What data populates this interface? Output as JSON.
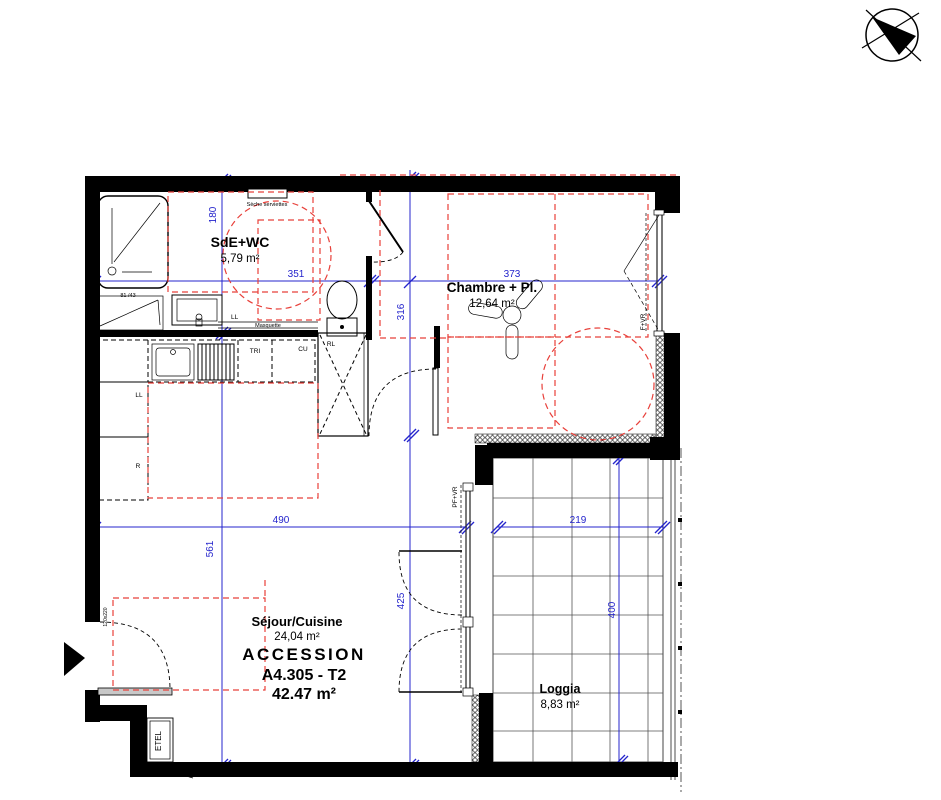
{
  "plan": {
    "program": "ACCESSION",
    "lot_reference": "A4.305 - T2",
    "total_area": "42.47 m²"
  },
  "rooms": {
    "sde": {
      "name": "SdE+WC",
      "area": "5,79 m²"
    },
    "chambre": {
      "name": "Chambre + Pl.",
      "area": "12,64 m²"
    },
    "sejour": {
      "name": "Séjour/Cuisine",
      "area": "24,04 m²"
    },
    "loggia": {
      "name": "Loggia",
      "area": "8,83 m²"
    }
  },
  "fixtures": {
    "towel_dryer": "Sèche serviettes",
    "masquette": "Masquette",
    "washbasin": "81 /43",
    "washing_machine": "LL",
    "trash": "TRI",
    "cooking": "CU",
    "closet": "RL",
    "fridge": "R",
    "electrical": "ETEL",
    "window_bedroom": "F+VR",
    "window_living": "PF+VR",
    "entry_door": "120x220"
  },
  "dimensions_cm": {
    "d180": "180",
    "d351": "351",
    "d373": "373",
    "d316": "316",
    "d561": "561",
    "d490": "490",
    "d425": "425",
    "d219": "219",
    "d400": "400"
  },
  "colors": {
    "dimension": "#2424cc",
    "accessibility": "#e8403a",
    "wall": "#000000"
  }
}
